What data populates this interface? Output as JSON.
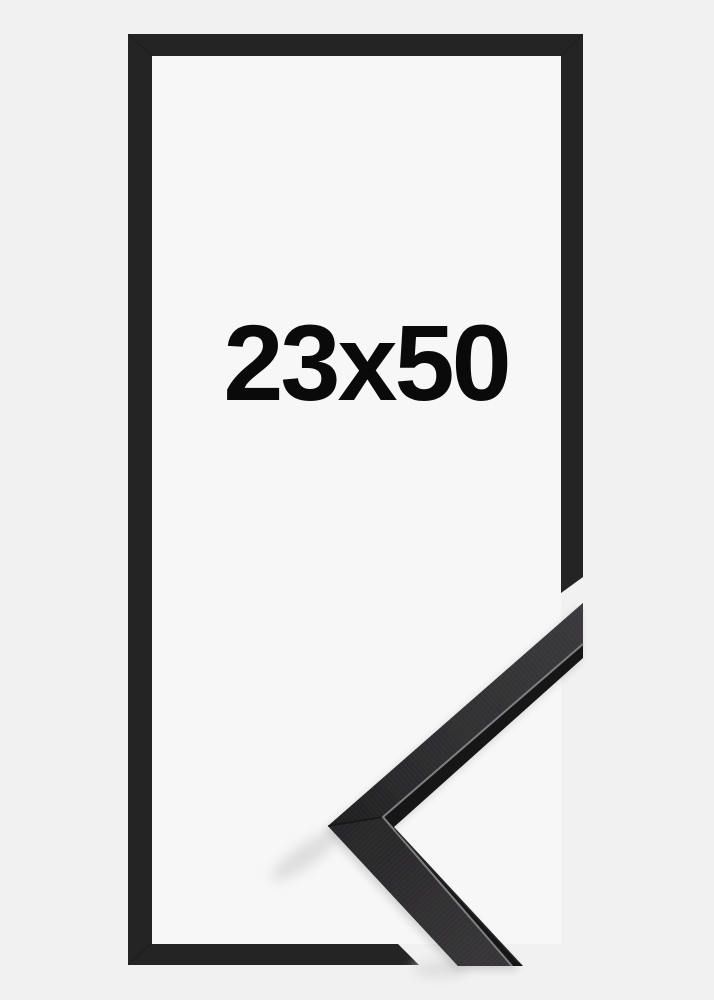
{
  "product": {
    "size_label": "23x50"
  },
  "colors": {
    "background": "#f1f1f1",
    "frame_interior": "#f7f7f7",
    "frame_outline": "#242424",
    "moulding_edge": "#161618",
    "moulding_highlight": "#8a888c",
    "label_text": "#0a0a0a"
  }
}
